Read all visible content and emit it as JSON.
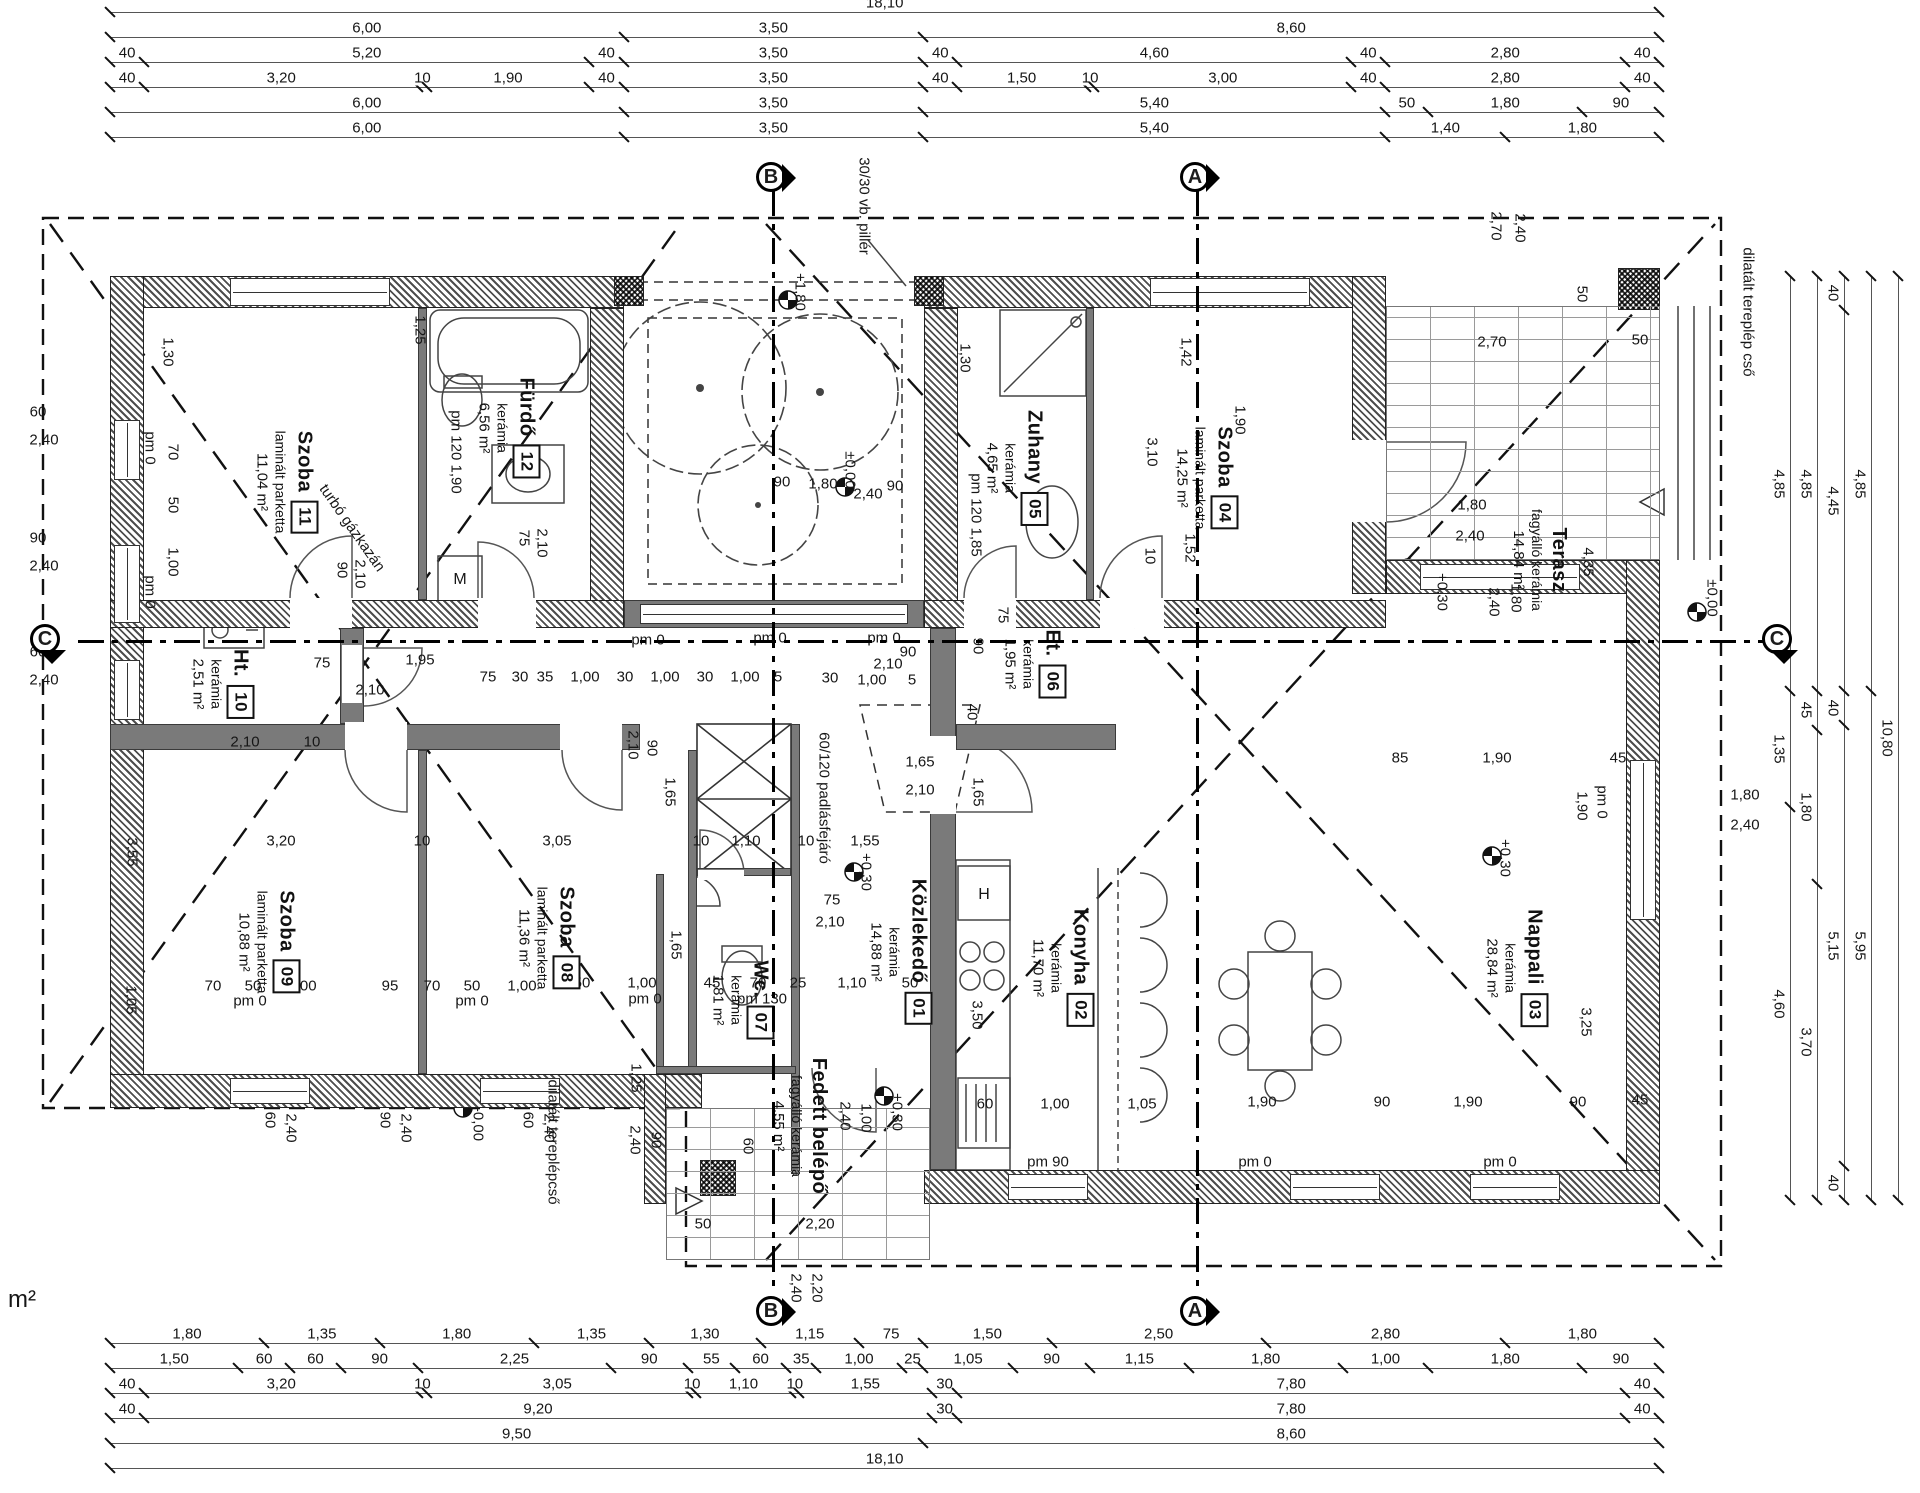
{
  "drawing": {
    "type": "architectural floor plan",
    "stray_note": "m²"
  },
  "axes": [
    {
      "letter": "B"
    },
    {
      "letter": "A"
    },
    {
      "letter": "C"
    }
  ],
  "rooms": [
    {
      "num": "01",
      "name": "Közlekedő",
      "finish": "kerámia",
      "area": "14,88 m²",
      "x": 900,
      "y": 952
    },
    {
      "num": "02",
      "name": "Konyha",
      "finish": "kerámia",
      "area": "11,70 m²",
      "x": 1062,
      "y": 968
    },
    {
      "num": "03",
      "name": "Nappali",
      "finish": "kerámia",
      "area": "28,84 m²",
      "x": 1516,
      "y": 968
    },
    {
      "num": "04",
      "name": "Szoba",
      "finish": "laminált parketta",
      "area": "14,25 m²",
      "x": 1206,
      "y": 478
    },
    {
      "num": "05",
      "name": "Zuhany",
      "finish": "kerámia",
      "area": "4,65 m²",
      "x": 1016,
      "y": 468
    },
    {
      "num": "06",
      "name": "Et.",
      "finish": "kerámia",
      "area": "1,95 m²",
      "x": 1034,
      "y": 664
    },
    {
      "num": "07",
      "name": "Wc.",
      "finish": "kerámia",
      "area": "1,81 m²",
      "x": 742,
      "y": 1000
    },
    {
      "num": "08",
      "name": "Szoba",
      "finish": "laminált parketta",
      "area": "11,36 m²",
      "x": 548,
      "y": 938
    },
    {
      "num": "09",
      "name": "Szoba",
      "finish": "laminált parketta",
      "area": "10,88 m²",
      "x": 268,
      "y": 942
    },
    {
      "num": "10",
      "name": "Ht.",
      "finish": "kerámia",
      "area": "2,51 m²",
      "x": 222,
      "y": 684
    },
    {
      "num": "11",
      "name": "Szoba",
      "finish": "laminált parketta",
      "area": "11,04 m²",
      "x": 286,
      "y": 482
    },
    {
      "num": "12",
      "name": "Fürdő",
      "finish": "kerámia",
      "area": "6,56 m²",
      "x": 508,
      "y": 428
    },
    {
      "num": "",
      "name": "Terasz",
      "finish": "fagyálló kerámia",
      "area": "14,84 m²",
      "x": 1540,
      "y": 560
    },
    {
      "num": "",
      "name": "Fedett belépő",
      "finish": "fagyálló kerámia",
      "area": "4,55 m²",
      "x": 800,
      "y": 1126
    }
  ],
  "dimensions": {
    "top": [
      [
        "18,10"
      ],
      [
        "6,00",
        "3,50",
        "8,60"
      ],
      [
        "40",
        "5,20",
        "40",
        "3,50",
        "40",
        "4,60",
        "40",
        "2,80",
        "40"
      ],
      [
        "40",
        "3,20",
        "10",
        "1,90",
        "40",
        "3,50",
        "40",
        "1,50",
        "10",
        "3,00",
        "40",
        "2,80",
        "40"
      ],
      [
        "6,00",
        "3,50",
        "5,40",
        "50",
        "1,80",
        "90"
      ],
      [
        "6,00",
        "3,50",
        "5,40",
        "1,40",
        "1,80"
      ]
    ],
    "bottom": [
      [
        "1,80",
        "1,35",
        "1,80",
        "1,35",
        "1,30",
        "1,15",
        "75",
        "1,50",
        "2,50",
        "2,80",
        "1,80"
      ],
      [
        "1,50",
        "60",
        "60",
        "90",
        "2,25",
        "90",
        "55",
        "60",
        "35",
        "1,00",
        "25",
        "1,05",
        "90",
        "1,15",
        "1,80",
        "1,00",
        "1,80",
        "90"
      ],
      [
        "40",
        "3,20",
        "10",
        "3,05",
        "10",
        "1,10",
        "10",
        "1,55",
        "30",
        "7,80",
        "40"
      ],
      [
        "40",
        "9,20",
        "30",
        "7,80",
        "40"
      ],
      [
        "9,50",
        "8,60"
      ],
      [
        "18,10"
      ]
    ],
    "right": [
      [
        "4,85",
        "1,35",
        "4,60"
      ],
      [
        "4,85",
        "45",
        "1,80",
        "3,70"
      ],
      [
        "40",
        "4,45",
        "40",
        "5,15",
        "40"
      ],
      [
        "4,85",
        "5,95"
      ],
      [
        "10,80"
      ]
    ]
  },
  "annotations": {
    "labels": [
      {
        "t": "1,30",
        "x": 168,
        "y": 352,
        "r": 90
      },
      {
        "t": "pm 0",
        "x": 150,
        "y": 448,
        "r": 90
      },
      {
        "t": "70",
        "x": 173,
        "y": 452,
        "r": 90
      },
      {
        "t": "50",
        "x": 173,
        "y": 505,
        "r": 90
      },
      {
        "t": "1,00",
        "x": 173,
        "y": 562,
        "r": 90
      },
      {
        "t": "pm 0",
        "x": 150,
        "y": 592,
        "r": 90
      },
      {
        "t": "90",
        "x": 342,
        "y": 570,
        "r": 90
      },
      {
        "t": "2,10",
        "x": 360,
        "y": 574,
        "r": 90
      },
      {
        "t": "1,25",
        "x": 420,
        "y": 330,
        "r": 90
      },
      {
        "t": "pm 120 1,90",
        "x": 456,
        "y": 452,
        "r": 90
      },
      {
        "t": "75",
        "x": 524,
        "y": 538,
        "r": 90
      },
      {
        "t": "2,10",
        "x": 542,
        "y": 543,
        "r": 90
      },
      {
        "t": "2,10",
        "x": 633,
        "y": 745,
        "r": 90
      },
      {
        "t": "90",
        "x": 652,
        "y": 748,
        "r": 90
      },
      {
        "t": "1,65",
        "x": 670,
        "y": 792,
        "r": 90
      },
      {
        "t": "1,30",
        "x": 965,
        "y": 358,
        "r": 90
      },
      {
        "t": "pm 120 1,85",
        "x": 976,
        "y": 515,
        "r": 90
      },
      {
        "t": "3,10",
        "x": 1152,
        "y": 452,
        "r": 90
      },
      {
        "t": "1,42",
        "x": 1186,
        "y": 352,
        "r": 90
      },
      {
        "t": "1,90",
        "x": 1240,
        "y": 420,
        "r": 90
      },
      {
        "t": "10",
        "x": 1150,
        "y": 556,
        "r": 90
      },
      {
        "t": "1,52",
        "x": 1190,
        "y": 548,
        "r": 90
      },
      {
        "t": "75",
        "x": 1003,
        "y": 615,
        "r": 90
      },
      {
        "t": "90",
        "x": 978,
        "y": 646,
        "r": 90
      },
      {
        "t": "40",
        "x": 972,
        "y": 712,
        "r": 90
      },
      {
        "t": "1,65",
        "x": 978,
        "y": 792,
        "r": 90
      },
      {
        "t": "60/120 padlásfejáró",
        "x": 824,
        "y": 798,
        "r": 90
      },
      {
        "t": "+0,30",
        "x": 866,
        "y": 872,
        "r": 90
      },
      {
        "t": "1,65",
        "x": 676,
        "y": 945,
        "r": 90
      },
      {
        "t": "3,55",
        "x": 132,
        "y": 852,
        "r": 90
      },
      {
        "t": "1,05",
        "x": 131,
        "y": 1000,
        "r": 90
      },
      {
        "t": "+0,30",
        "x": 1505,
        "y": 858,
        "r": 90
      },
      {
        "t": "pm 0",
        "x": 1602,
        "y": 802,
        "r": 90
      },
      {
        "t": "1,90",
        "x": 1582,
        "y": 806,
        "r": 90
      },
      {
        "t": "3,25",
        "x": 1586,
        "y": 1022,
        "r": 90
      },
      {
        "t": "3,50",
        "x": 977,
        "y": 1015,
        "r": 90
      },
      {
        "t": "+0,30",
        "x": 1442,
        "y": 592,
        "r": 90
      },
      {
        "t": "±0,00",
        "x": 1712,
        "y": 598,
        "r": 90
      },
      {
        "t": "50",
        "x": 1582,
        "y": 294,
        "r": 90
      },
      {
        "t": "4,35",
        "x": 1588,
        "y": 562,
        "r": 90
      },
      {
        "t": "2,40",
        "x": 1494,
        "y": 602,
        "r": 90
      },
      {
        "t": "1,80",
        "x": 1516,
        "y": 598,
        "r": 90
      },
      {
        "t": "2,70",
        "x": 1496,
        "y": 226,
        "r": 90
      },
      {
        "t": "2,40",
        "x": 1520,
        "y": 228,
        "r": 90
      },
      {
        "t": "dilatált tereplép cső",
        "x": 1748,
        "y": 312,
        "r": 90
      },
      {
        "t": "dilatált tereplépcső",
        "x": 553,
        "y": 1142,
        "r": 90
      },
      {
        "t": "-0,00",
        "x": 478,
        "y": 1124,
        "r": 90
      },
      {
        "t": "+1,80",
        "x": 800,
        "y": 292,
        "r": 90
      },
      {
        "t": "±0,00",
        "x": 850,
        "y": 470,
        "r": 90
      },
      {
        "t": "30/30 vb. pillér",
        "x": 864,
        "y": 206,
        "r": 90
      },
      {
        "t": "+0,30",
        "x": 897,
        "y": 1112,
        "r": 90
      },
      {
        "t": "2,40",
        "x": 635,
        "y": 1140,
        "r": 90
      },
      {
        "t": "90",
        "x": 656,
        "y": 1140,
        "r": 90
      },
      {
        "t": "2,40",
        "x": 845,
        "y": 1116,
        "r": 90
      },
      {
        "t": "1,00",
        "x": 866,
        "y": 1118,
        "r": 90
      },
      {
        "t": "60",
        "x": 748,
        "y": 1146,
        "r": 90
      },
      {
        "t": "1,25",
        "x": 636,
        "y": 1078,
        "r": 90
      },
      {
        "t": "2,40",
        "x": 796,
        "y": 1288,
        "r": 90
      },
      {
        "t": "2,20",
        "x": 817,
        "y": 1288,
        "r": 90
      },
      {
        "t": "60",
        "x": 270,
        "y": 1120,
        "r": 90
      },
      {
        "t": "2,40",
        "x": 291,
        "y": 1128,
        "r": 90
      },
      {
        "t": "90",
        "x": 385,
        "y": 1120,
        "r": 90
      },
      {
        "t": "2,40",
        "x": 406,
        "y": 1128,
        "r": 90
      },
      {
        "t": "60",
        "x": 528,
        "y": 1120,
        "r": 90
      },
      {
        "t": "2,40",
        "x": 549,
        "y": 1128,
        "r": 90
      },
      {
        "t": "turbó gázkazán",
        "x": 352,
        "y": 528,
        "r": 55
      },
      {
        "t": "60",
        "x": 38,
        "y": 412
      },
      {
        "t": "2,40",
        "x": 44,
        "y": 440
      },
      {
        "t": "90",
        "x": 38,
        "y": 538
      },
      {
        "t": "2,40",
        "x": 44,
        "y": 566
      },
      {
        "t": "60",
        "x": 38,
        "y": 652
      },
      {
        "t": "2,40",
        "x": 44,
        "y": 680
      },
      {
        "t": "2,70",
        "x": 1492,
        "y": 342
      },
      {
        "t": "50",
        "x": 1640,
        "y": 340
      },
      {
        "t": "1,80",
        "x": 1472,
        "y": 505
      },
      {
        "t": "2,40",
        "x": 1470,
        "y": 536
      },
      {
        "t": "pm 0",
        "x": 648,
        "y": 640
      },
      {
        "t": "pm 0",
        "x": 770,
        "y": 638
      },
      {
        "t": "pm 0",
        "x": 884,
        "y": 638
      },
      {
        "t": "90",
        "x": 908,
        "y": 652
      },
      {
        "t": "2,10",
        "x": 888,
        "y": 664
      },
      {
        "t": "30",
        "x": 830,
        "y": 678
      },
      {
        "t": "1,00",
        "x": 872,
        "y": 680
      },
      {
        "t": "5",
        "x": 912,
        "y": 680
      },
      {
        "t": "75",
        "x": 322,
        "y": 663
      },
      {
        "t": "1,95",
        "x": 420,
        "y": 660
      },
      {
        "t": "2,10",
        "x": 370,
        "y": 690
      },
      {
        "t": "2,10",
        "x": 245,
        "y": 742
      },
      {
        "t": "10",
        "x": 312,
        "y": 742
      },
      {
        "t": "75",
        "x": 488,
        "y": 677
      },
      {
        "t": "30",
        "x": 520,
        "y": 677
      },
      {
        "t": "35",
        "x": 545,
        "y": 677
      },
      {
        "t": "1,00",
        "x": 585,
        "y": 677
      },
      {
        "t": "30",
        "x": 625,
        "y": 677
      },
      {
        "t": "1,00",
        "x": 665,
        "y": 677
      },
      {
        "t": "30",
        "x": 705,
        "y": 677
      },
      {
        "t": "1,00",
        "x": 745,
        "y": 677
      },
      {
        "t": "5",
        "x": 778,
        "y": 677
      },
      {
        "t": "3,20",
        "x": 281,
        "y": 841
      },
      {
        "t": "10",
        "x": 422,
        "y": 841
      },
      {
        "t": "3,05",
        "x": 557,
        "y": 841
      },
      {
        "t": "10",
        "x": 701,
        "y": 841
      },
      {
        "t": "1,10",
        "x": 746,
        "y": 841
      },
      {
        "t": "10",
        "x": 806,
        "y": 841
      },
      {
        "t": "1,55",
        "x": 865,
        "y": 841
      },
      {
        "t": "75",
        "x": 832,
        "y": 900
      },
      {
        "t": "2,10",
        "x": 830,
        "y": 922
      },
      {
        "t": "1,65",
        "x": 920,
        "y": 762
      },
      {
        "t": "2,10",
        "x": 920,
        "y": 790
      },
      {
        "t": "50",
        "x": 582,
        "y": 983
      },
      {
        "t": "1,00",
        "x": 642,
        "y": 983
      },
      {
        "t": "pm 0",
        "x": 645,
        "y": 999
      },
      {
        "t": "45",
        "x": 712,
        "y": 983
      },
      {
        "t": "70",
        "x": 758,
        "y": 983
      },
      {
        "t": "25",
        "x": 798,
        "y": 983
      },
      {
        "t": "pm 130",
        "x": 762,
        "y": 999
      },
      {
        "t": "1,10",
        "x": 852,
        "y": 983
      },
      {
        "t": "50",
        "x": 910,
        "y": 983
      },
      {
        "t": "70",
        "x": 213,
        "y": 986
      },
      {
        "t": "50",
        "x": 253,
        "y": 986
      },
      {
        "t": "1,00",
        "x": 302,
        "y": 986
      },
      {
        "t": "pm 0",
        "x": 250,
        "y": 1001
      },
      {
        "t": "95",
        "x": 390,
        "y": 986
      },
      {
        "t": "70",
        "x": 432,
        "y": 986
      },
      {
        "t": "50",
        "x": 472,
        "y": 986
      },
      {
        "t": "1,00",
        "x": 522,
        "y": 986
      },
      {
        "t": "pm 0",
        "x": 472,
        "y": 1001
      },
      {
        "t": "60",
        "x": 985,
        "y": 1104
      },
      {
        "t": "1,00",
        "x": 1055,
        "y": 1104
      },
      {
        "t": "1,05",
        "x": 1142,
        "y": 1104
      },
      {
        "t": "1,90",
        "x": 1262,
        "y": 1102
      },
      {
        "t": "90",
        "x": 1382,
        "y": 1102
      },
      {
        "t": "1,90",
        "x": 1468,
        "y": 1102
      },
      {
        "t": "90",
        "x": 1578,
        "y": 1102
      },
      {
        "t": "45",
        "x": 1640,
        "y": 1100
      },
      {
        "t": "pm 90",
        "x": 1048,
        "y": 1162
      },
      {
        "t": "pm 0",
        "x": 1255,
        "y": 1162
      },
      {
        "t": "pm 0",
        "x": 1500,
        "y": 1162
      },
      {
        "t": "85",
        "x": 1400,
        "y": 758
      },
      {
        "t": "1,90",
        "x": 1497,
        "y": 758
      },
      {
        "t": "45",
        "x": 1618,
        "y": 758
      },
      {
        "t": "50",
        "x": 703,
        "y": 1224
      },
      {
        "t": "2,20",
        "x": 820,
        "y": 1224
      },
      {
        "t": "90",
        "x": 782,
        "y": 482
      },
      {
        "t": "1,80",
        "x": 823,
        "y": 484
      },
      {
        "t": "2,40",
        "x": 868,
        "y": 494
      },
      {
        "t": "90",
        "x": 895,
        "y": 486
      },
      {
        "t": "1,80",
        "x": 1745,
        "y": 795
      },
      {
        "t": "2,40",
        "x": 1745,
        "y": 825
      },
      {
        "t": "H",
        "x": 984,
        "y": 895,
        "fs": 16
      },
      {
        "t": "M",
        "x": 460,
        "y": 580,
        "fs": 16
      },
      {
        "t": "m²",
        "x": 22,
        "y": 1300,
        "fs": 24
      }
    ]
  }
}
